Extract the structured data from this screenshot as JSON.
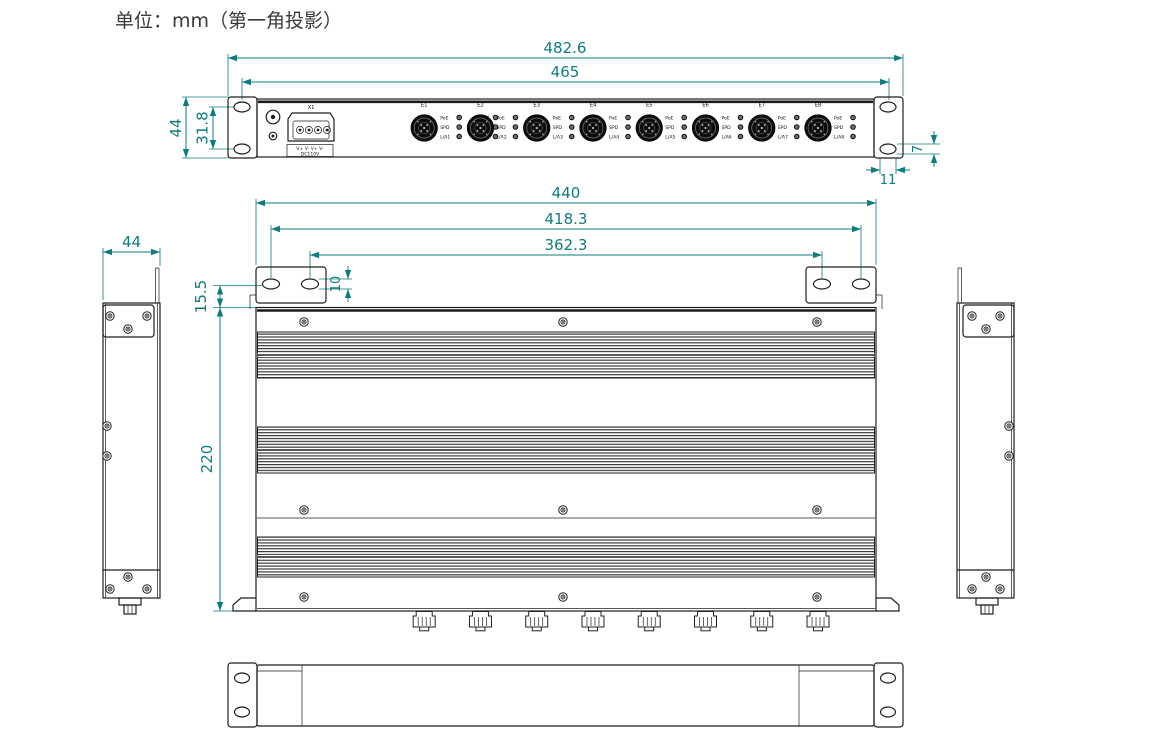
{
  "title": "单位：mm（第一角投影）",
  "colors": {
    "dimension": "#0e7c7e",
    "line": "#1f1f1f",
    "background": "#ffffff"
  },
  "dimensions": {
    "front_overall_width": "482.6",
    "front_mount_width": "465",
    "front_height": "44",
    "front_hole_spacing": "31.8",
    "front_slot_width": "11",
    "front_slot_height": "7",
    "top_body_width": "440",
    "top_outer_slot_spacing": "418.3",
    "top_inner_slot_spacing": "362.3",
    "top_ear_offset": "15.5",
    "top_slot_height": "10",
    "top_body_depth": "220",
    "side_width": "44"
  },
  "front_panel": {
    "connector_label": "X1",
    "terminal_row1": "V+ V- V+ V-",
    "terminal_row2": "DC110V",
    "status_leds": [
      "ALM",
      "RUN",
      "PWR"
    ],
    "ports": [
      {
        "label": "E1",
        "leds": [
          "PoE",
          "SPD",
          "L/A1"
        ]
      },
      {
        "label": "E2",
        "leds": [
          "PoE",
          "SPD",
          "L/A2"
        ]
      },
      {
        "label": "E3",
        "leds": [
          "PoE",
          "SPD",
          "L/A3"
        ]
      },
      {
        "label": "E4",
        "leds": [
          "PoE",
          "SPD",
          "L/A4"
        ]
      },
      {
        "label": "E5",
        "leds": [
          "PoE",
          "SPD",
          "L/A5"
        ]
      },
      {
        "label": "E6",
        "leds": [
          "PoE",
          "SPD",
          "L/A6"
        ]
      },
      {
        "label": "E7",
        "leds": [
          "PoE",
          "SPD",
          "L/A7"
        ]
      },
      {
        "label": "E8",
        "leds": [
          "PoE",
          "SPD",
          "L/A8"
        ]
      }
    ]
  }
}
